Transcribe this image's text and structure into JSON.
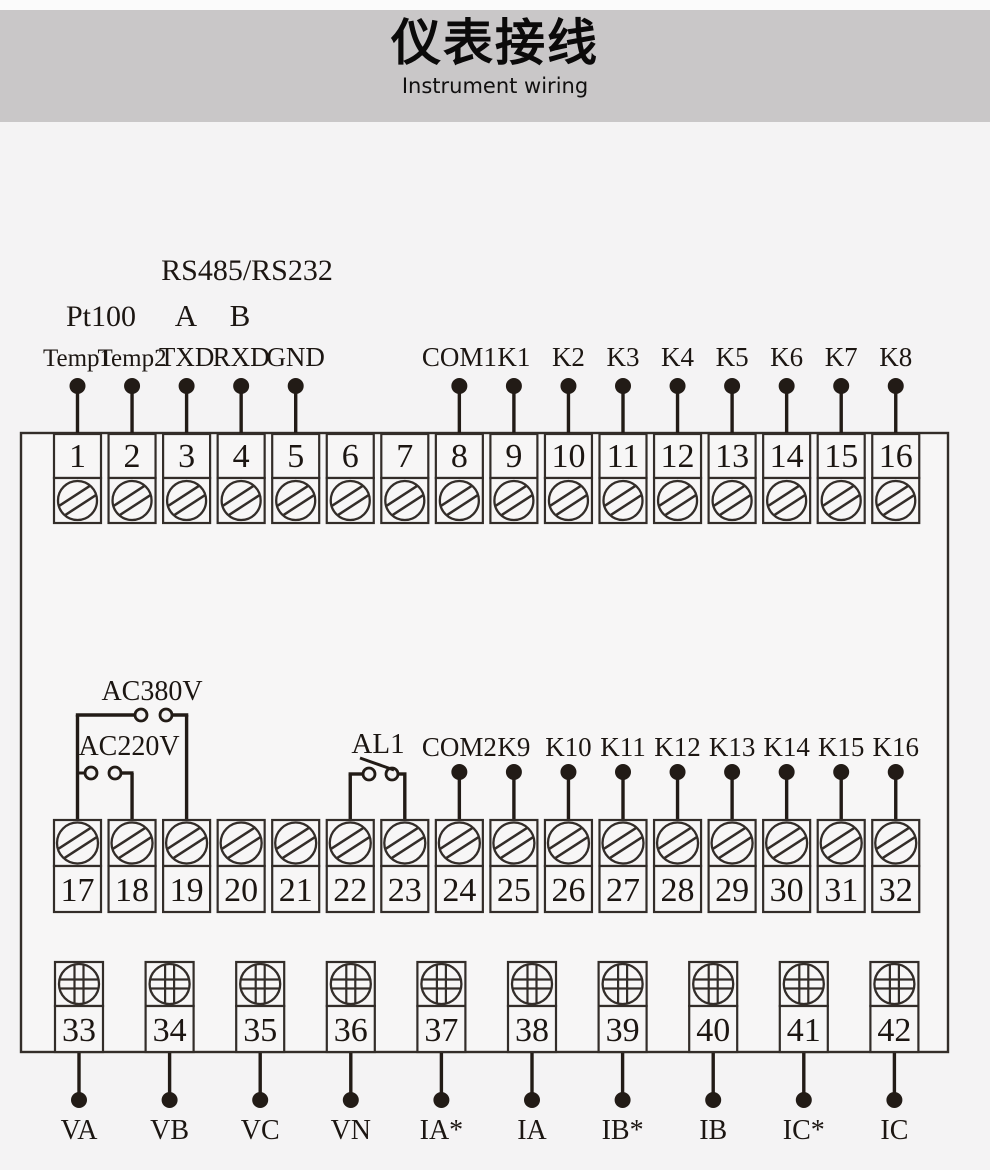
{
  "header": {
    "title": "仪表接线",
    "subtitle": "Instrument wiring"
  },
  "colors": {
    "header_bg": "#c9c7c8",
    "page_bg": "#f4f3f4",
    "box_fill": "#f7f6f6",
    "line": "#332d29",
    "wire": "#221b16",
    "text": "#1c1612"
  },
  "top_row": {
    "annotations": {
      "sensor": "Pt100",
      "bus": "RS485/RS232",
      "bus_a": "A",
      "bus_b": "B"
    },
    "terminals": [
      {
        "num": "1",
        "label": "Temp1"
      },
      {
        "num": "2",
        "label": "Temp2"
      },
      {
        "num": "3",
        "label": "TXD"
      },
      {
        "num": "4",
        "label": "RXD"
      },
      {
        "num": "5",
        "label": "GND"
      },
      {
        "num": "6"
      },
      {
        "num": "7"
      },
      {
        "num": "8",
        "label": "COM1"
      },
      {
        "num": "9",
        "label": "K1"
      },
      {
        "num": "10",
        "label": "K2"
      },
      {
        "num": "11",
        "label": "K3"
      },
      {
        "num": "12",
        "label": "K4"
      },
      {
        "num": "13",
        "label": "K5"
      },
      {
        "num": "14",
        "label": "K6"
      },
      {
        "num": "15",
        "label": "K7"
      },
      {
        "num": "16",
        "label": "K8"
      }
    ]
  },
  "middle_row": {
    "switch_labels": {
      "ac380": "AC380V",
      "ac220": "AC220V",
      "al1": "AL1"
    },
    "terminals": [
      {
        "num": "17"
      },
      {
        "num": "18"
      },
      {
        "num": "19"
      },
      {
        "num": "20"
      },
      {
        "num": "21"
      },
      {
        "num": "22"
      },
      {
        "num": "23"
      },
      {
        "num": "24",
        "label": "COM2"
      },
      {
        "num": "25",
        "label": "K9"
      },
      {
        "num": "26",
        "label": "K10"
      },
      {
        "num": "27",
        "label": "K11"
      },
      {
        "num": "28",
        "label": "K12"
      },
      {
        "num": "29",
        "label": "K13"
      },
      {
        "num": "30",
        "label": "K14"
      },
      {
        "num": "31",
        "label": "K15"
      },
      {
        "num": "32",
        "label": "K16"
      }
    ]
  },
  "bottom_row": {
    "terminals": [
      {
        "num": "33",
        "label": "VA"
      },
      {
        "num": "34",
        "label": "VB"
      },
      {
        "num": "35",
        "label": "VC"
      },
      {
        "num": "36",
        "label": "VN"
      },
      {
        "num": "37",
        "label": "IA*"
      },
      {
        "num": "38",
        "label": "IA"
      },
      {
        "num": "39",
        "label": "IB*"
      },
      {
        "num": "40",
        "label": "IB"
      },
      {
        "num": "41",
        "label": "IC*"
      },
      {
        "num": "42",
        "label": "IC"
      }
    ]
  }
}
